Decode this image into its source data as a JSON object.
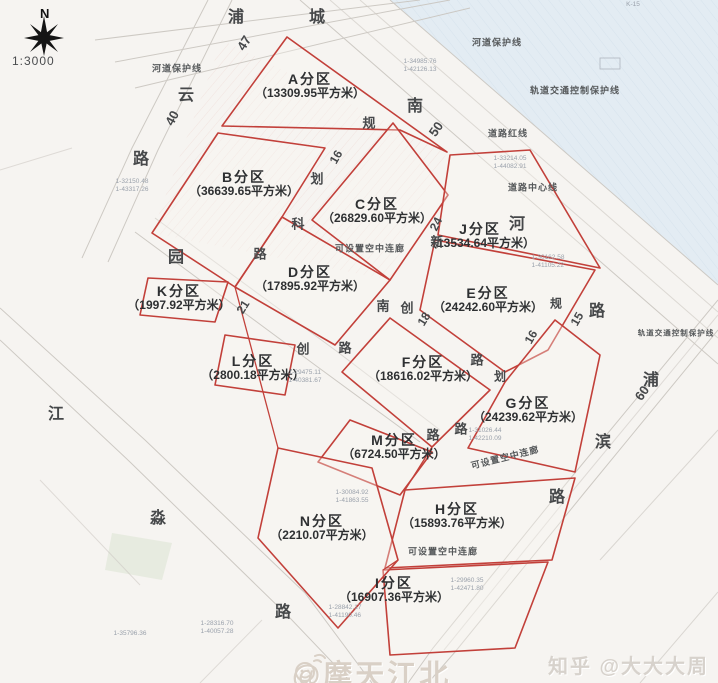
{
  "compass": {
    "letter": "N",
    "scale": "1:3000"
  },
  "parcels": [
    {
      "id": "A",
      "name": "A分区",
      "area": "（13309.95平方米）",
      "x": 310,
      "y": 86
    },
    {
      "id": "B",
      "name": "B分区",
      "area": "（36639.65平方米）",
      "x": 244,
      "y": 184
    },
    {
      "id": "C",
      "name": "C分区",
      "area": "（26829.60平方米）",
      "x": 377,
      "y": 211
    },
    {
      "id": "D",
      "name": "D分区",
      "area": "（17895.92平方米）",
      "x": 310,
      "y": 279
    },
    {
      "id": "E",
      "name": "E分区",
      "area": "（24242.60平方米）",
      "x": 488,
      "y": 300
    },
    {
      "id": "F",
      "name": "F分区",
      "area": "（18616.02平方米）",
      "x": 423,
      "y": 369
    },
    {
      "id": "G",
      "name": "G分区",
      "area": "（24239.62平方米）",
      "x": 528,
      "y": 410
    },
    {
      "id": "H",
      "name": "H分区",
      "area": "（15893.76平方米）",
      "x": 457,
      "y": 516
    },
    {
      "id": "I",
      "name": "I分区",
      "area": "（16907.36平方米）",
      "x": 394,
      "y": 590
    },
    {
      "id": "J",
      "name": "J分区",
      "area": "（13534.64平方米）",
      "x": 480,
      "y": 236
    },
    {
      "id": "K",
      "name": "K分区",
      "area": "（1997.92平方米）",
      "x": 179,
      "y": 298
    },
    {
      "id": "L",
      "name": "L分区",
      "area": "（2800.18平方米）",
      "x": 253,
      "y": 368
    },
    {
      "id": "M",
      "name": "M分区",
      "area": "（6724.50平方米）",
      "x": 394,
      "y": 447
    },
    {
      "id": "N",
      "name": "N分区",
      "area": "（2210.07平方米）",
      "x": 322,
      "y": 528
    }
  ],
  "road_chars": [
    {
      "t": "浦",
      "x": 236,
      "y": 15
    },
    {
      "t": "城",
      "x": 317,
      "y": 15
    },
    {
      "t": "47",
      "x": 244,
      "y": 43,
      "r": -58,
      "s": 13
    },
    {
      "t": "云",
      "x": 186,
      "y": 93
    },
    {
      "t": "40",
      "x": 172,
      "y": 118,
      "r": -62,
      "s": 13
    },
    {
      "t": "路",
      "x": 141,
      "y": 157
    },
    {
      "t": "园",
      "x": 176,
      "y": 255
    },
    {
      "t": "江",
      "x": 56,
      "y": 412
    },
    {
      "t": "淼",
      "x": 158,
      "y": 516
    },
    {
      "t": "路",
      "x": 283,
      "y": 610
    },
    {
      "t": "南",
      "x": 415,
      "y": 104
    },
    {
      "t": "50",
      "x": 436,
      "y": 129,
      "r": -55,
      "s": 13
    },
    {
      "t": "河",
      "x": 517,
      "y": 222
    },
    {
      "t": "路",
      "x": 597,
      "y": 309
    },
    {
      "t": "浦",
      "x": 651,
      "y": 378
    },
    {
      "t": "60",
      "x": 642,
      "y": 393,
      "r": -55,
      "s": 13
    },
    {
      "t": "滨",
      "x": 603,
      "y": 440
    },
    {
      "t": "路",
      "x": 557,
      "y": 495
    },
    {
      "t": "规",
      "x": 369,
      "y": 122,
      "s": 13
    },
    {
      "t": "16",
      "x": 336,
      "y": 157,
      "r": -60,
      "s": 12
    },
    {
      "t": "划",
      "x": 317,
      "y": 178,
      "s": 13
    },
    {
      "t": "科",
      "x": 298,
      "y": 223,
      "s": 13
    },
    {
      "t": "路",
      "x": 260,
      "y": 253,
      "s": 13
    },
    {
      "t": "24",
      "x": 436,
      "y": 224,
      "r": -64,
      "s": 12
    },
    {
      "t": "新",
      "x": 437,
      "y": 241,
      "s": 13
    },
    {
      "t": "21",
      "x": 243,
      "y": 307,
      "r": -58,
      "s": 12
    },
    {
      "t": "南",
      "x": 383,
      "y": 305,
      "s": 13
    },
    {
      "t": "创",
      "x": 407,
      "y": 307,
      "s": 13
    },
    {
      "t": "18",
      "x": 424,
      "y": 319,
      "r": -58,
      "s": 12
    },
    {
      "t": "路",
      "x": 477,
      "y": 359,
      "s": 13
    },
    {
      "t": "创",
      "x": 303,
      "y": 348,
      "s": 13
    },
    {
      "t": "路",
      "x": 345,
      "y": 347,
      "s": 13
    },
    {
      "t": "规",
      "x": 556,
      "y": 303,
      "s": 12
    },
    {
      "t": "16",
      "x": 531,
      "y": 337,
      "r": -60,
      "s": 12
    },
    {
      "t": "划",
      "x": 500,
      "y": 376,
      "s": 12
    },
    {
      "t": "15",
      "x": 577,
      "y": 319,
      "r": -60,
      "s": 12
    },
    {
      "t": "路",
      "x": 433,
      "y": 434,
      "s": 13
    },
    {
      "t": "路",
      "x": 461,
      "y": 428,
      "s": 13
    }
  ],
  "notes": [
    {
      "t": "河道保护线",
      "x": 177,
      "y": 68
    },
    {
      "t": "河道保护线",
      "x": 497,
      "y": 42
    },
    {
      "t": "轨道交通控制保护线",
      "x": 575,
      "y": 90
    },
    {
      "t": "道路红线",
      "x": 508,
      "y": 133
    },
    {
      "t": "道路中心线",
      "x": 533,
      "y": 187
    },
    {
      "t": "轨道交通控制保护线",
      "x": 676,
      "y": 333,
      "s": 7.5
    },
    {
      "t": "可设置空中连廊",
      "x": 370,
      "y": 248
    },
    {
      "t": "可设置空中连廊",
      "x": 505,
      "y": 457,
      "r": -14
    },
    {
      "t": "可设置空中连廊",
      "x": 443,
      "y": 551
    }
  ],
  "survey_marks": [
    {
      "t1": "1-34985.76",
      "t2": "1-42126.13",
      "x": 420,
      "y": 66
    },
    {
      "t1": "1-30162.58",
      "t2": "1-41105.22",
      "x": 548,
      "y": 262
    },
    {
      "t1": "1-29475.11",
      "t2": "1-40381.67",
      "x": 305,
      "y": 377
    },
    {
      "t1": "1-31026.44",
      "t2": "1-42210.09",
      "x": 485,
      "y": 435
    },
    {
      "t1": "1-30084.92",
      "t2": "1-41863.55",
      "x": 352,
      "y": 497
    },
    {
      "t1": "1-29960.35",
      "t2": "1-42471.80",
      "x": 467,
      "y": 585
    },
    {
      "t1": "1-28842.17",
      "t2": "1-41190.46",
      "x": 345,
      "y": 612
    },
    {
      "t1": "1-28316.70",
      "t2": "1-40057.28",
      "x": 217,
      "y": 628
    },
    {
      "t1": "1-35796.36",
      "t2": "",
      "x": 130,
      "y": 634
    },
    {
      "t1": "1-33214.05",
      "t2": "1-44082.91",
      "x": 510,
      "y": 163
    },
    {
      "t1": "1-32150.48",
      "t2": "1-43317.26",
      "x": 132,
      "y": 186
    },
    {
      "t1": "K-15",
      "t2": "",
      "x": 633,
      "y": 5
    }
  ],
  "watermarks": {
    "left": "@摩天江北",
    "right": "知乎 @大大大周",
    "left_icon": "weibo-emoji-icon"
  }
}
